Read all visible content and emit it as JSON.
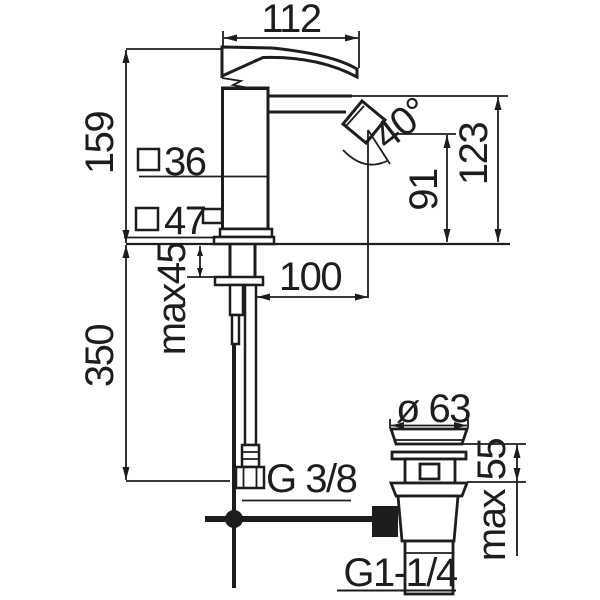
{
  "drawing": {
    "type": "technical-dimension-drawing",
    "subject": "single-lever basin/bidet mixer tap with pop-up waste",
    "colors": {
      "line": "#1d1d1b",
      "background": "#ffffff"
    }
  },
  "labels": {
    "spout_width": "112",
    "body_height": "159",
    "top_section": "36",
    "base_section": "47",
    "angle": "40°",
    "outlet_height": "91",
    "spout_height": "123",
    "reach": "100",
    "max_deck": "max45",
    "hose_length": "350",
    "supply_thread": "G 3/8",
    "waste_diameter": "ø 63",
    "waste_max": "max 55",
    "waste_thread": "G1-1/4"
  }
}
